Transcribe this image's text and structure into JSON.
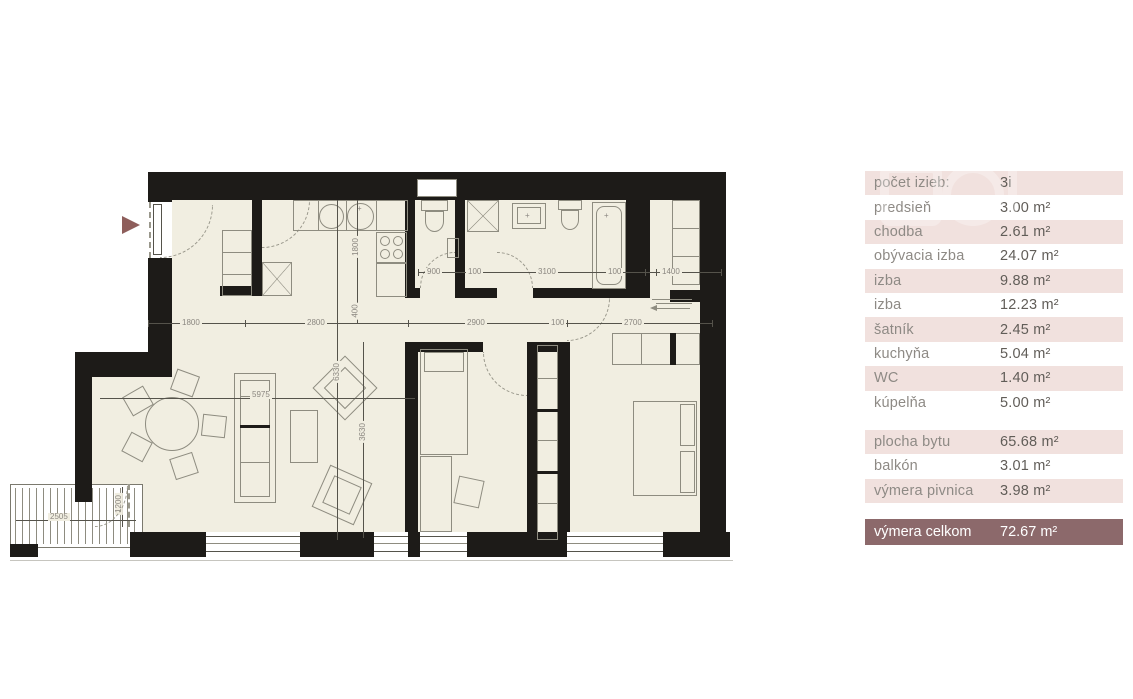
{
  "table": {
    "rows": [
      {
        "label": "počet izieb:",
        "value": "3i"
      },
      {
        "label": "predsieň",
        "value": "3.00 m²"
      },
      {
        "label": "chodba",
        "value": "2.61 m²"
      },
      {
        "label": "obývacia izba",
        "value": "24.07 m²"
      },
      {
        "label": "izba",
        "value": "9.88 m²"
      },
      {
        "label": "izba",
        "value": "12.23 m²"
      },
      {
        "label": "šatník",
        "value": "2.45 m²"
      },
      {
        "label": "kuchyňa",
        "value": "5.04 m²"
      },
      {
        "label": "WC",
        "value": "1.40 m²"
      },
      {
        "label": "kúpelňa",
        "value": "5.00 m²"
      }
    ],
    "summary": [
      {
        "label": "plocha bytu",
        "value": "65.68 m²"
      },
      {
        "label": "balkón",
        "value": "3.01 m²"
      },
      {
        "label": "výmera pivnica",
        "value": "3.98 m²"
      }
    ],
    "total": {
      "label": "výmera celkom",
      "value": "72.67 m²"
    }
  },
  "plan": {
    "dims": {
      "hall_width": "1800",
      "kitchen_width": "2800",
      "bedroom1_width": "2900",
      "wall_small_a": "100",
      "bedroom2_width": "2700",
      "wc_width": "900",
      "wall_small_b": "100",
      "bathroom_width": "3100",
      "wall_small_c": "100",
      "closet_width": "1400",
      "kitchen_depth": "1800",
      "nook_depth": "400",
      "living_height": "6330",
      "living_part_height": "3630",
      "living_width": "5975",
      "balcony_width": "2505",
      "balcony_depth": "1200"
    }
  },
  "colors": {
    "wall": "#1d1b18",
    "floor": "#f1eee1",
    "row_pink": "#f1e1de",
    "total_row": "#8c696b",
    "entrance_marker": "#8e5e5b",
    "dim_text": "#8b8780"
  }
}
